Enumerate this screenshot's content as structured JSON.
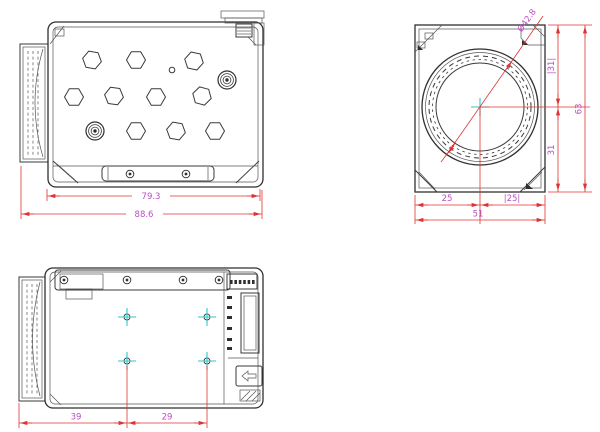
{
  "colors": {
    "linework": "#2f2f2f",
    "dimension_lines": "#e03232",
    "dimension_text": "#bb4ec4",
    "center_marks": "#2fc7c7",
    "background": "#ffffff"
  },
  "top_view": {
    "dim_inner_width": "79.3",
    "dim_overall_width": "88.6"
  },
  "front_view": {
    "dim_lens_diameter": "Ø42.8",
    "dim_left_to_center": "25",
    "dim_center_to_right": "|25|",
    "dim_overall_width": "51",
    "dim_top_to_center": "|31|",
    "dim_center_to_bottom": "31",
    "dim_overall_height": "63"
  },
  "bottom_view": {
    "dim_edge_to_hole": "39",
    "dim_hole_spacing": "29"
  }
}
